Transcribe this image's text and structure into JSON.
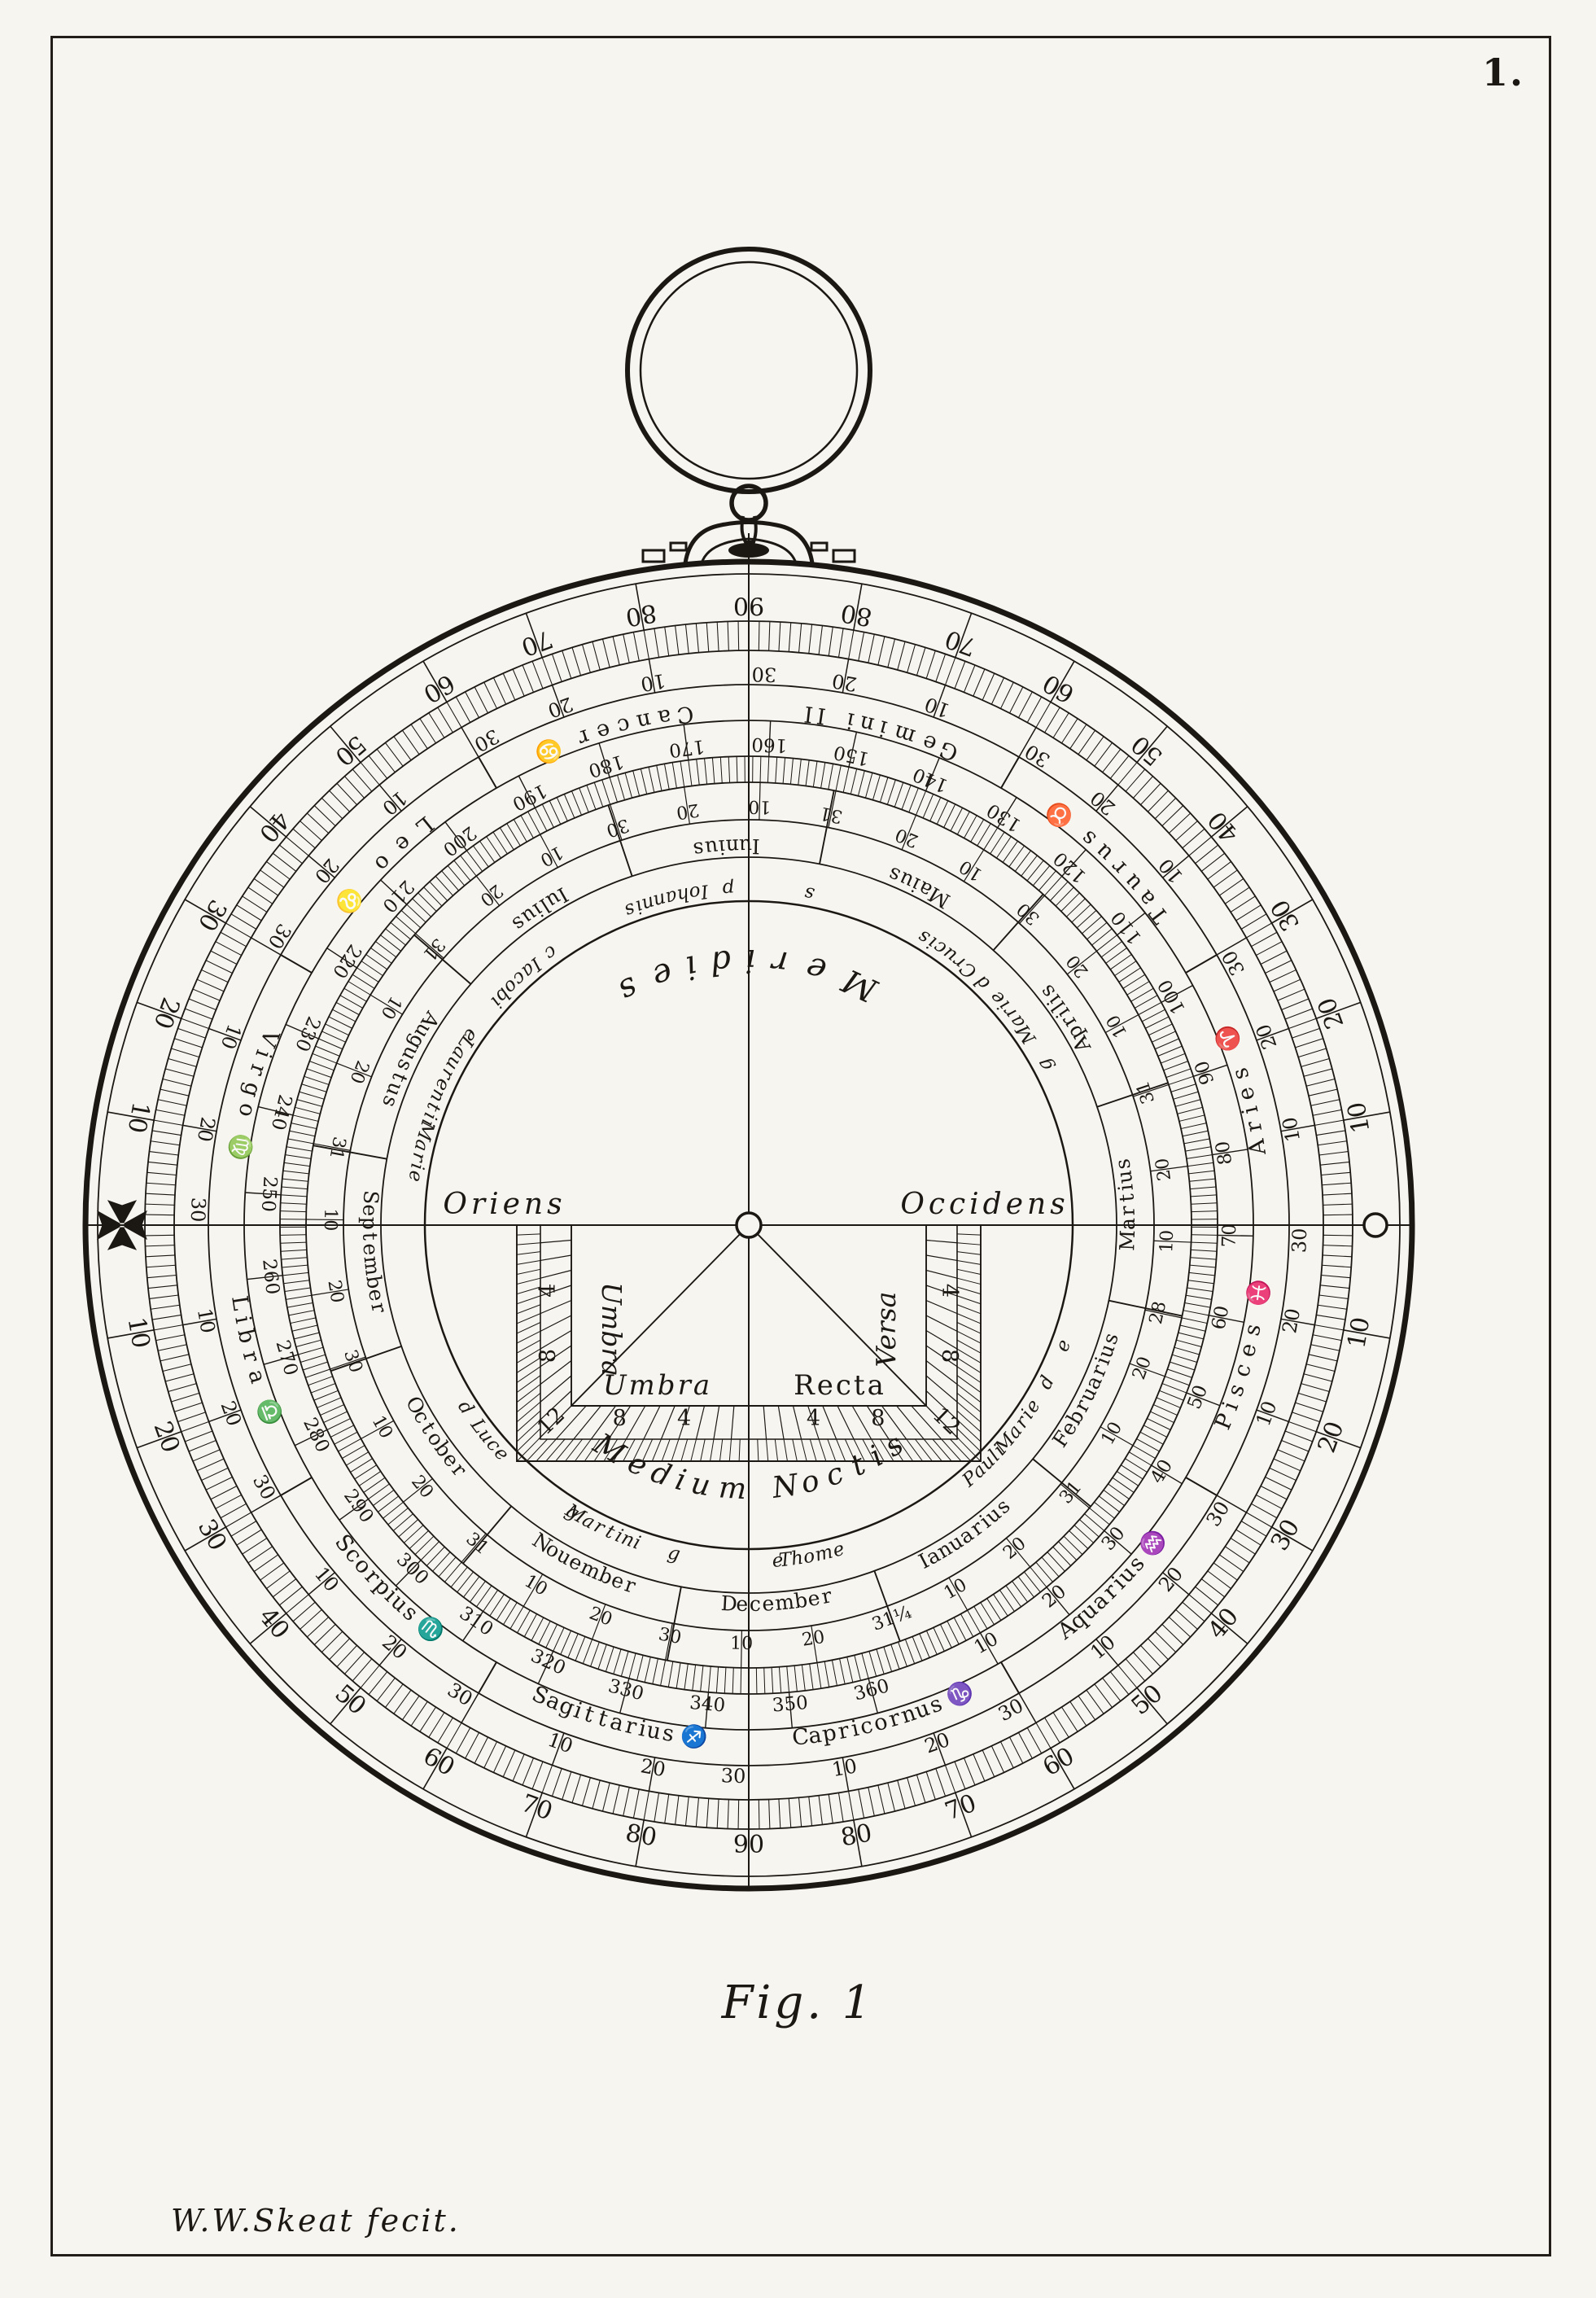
{
  "plate": {
    "number": "1.",
    "caption": "Fig. 1",
    "signature": "W.W.Skeat fecit."
  },
  "astrolabe": {
    "center_labels": {
      "top": "Meridies",
      "bottom": "Medium Noctis",
      "left": "Oriens",
      "right": "Occidens"
    },
    "shadow_square": {
      "left_label": "Umbra",
      "right_label": "Versa",
      "bottom_left_label": "Umbra",
      "bottom_right_label": "Recta",
      "scale_numbers": [
        4,
        8,
        12
      ]
    },
    "altitude_scale": {
      "step": 10,
      "max": 90
    },
    "zodiac_degree_labels": [
      10,
      20,
      30
    ],
    "zodiac": [
      {
        "name": "Capricornus",
        "symbol": "♑"
      },
      {
        "name": "Aquarius",
        "symbol": "♒"
      },
      {
        "name": "Pisces",
        "symbol": "♓"
      },
      {
        "name": "Aries",
        "symbol": "♈"
      },
      {
        "name": "Taurus",
        "symbol": "♉"
      },
      {
        "name": "Gemini",
        "symbol": "II"
      },
      {
        "name": "Cancer",
        "symbol": "♋"
      },
      {
        "name": "Leo",
        "symbol": "♌"
      },
      {
        "name": "Virgo",
        "symbol": "♍"
      },
      {
        "name": "Libra",
        "symbol": "♎"
      },
      {
        "name": "Scorpius",
        "symbol": "♏"
      },
      {
        "name": "Sagittarius",
        "symbol": "♐"
      }
    ],
    "day_scale": {
      "step": 10,
      "max": 360,
      "days_in_year": 365
    },
    "months": [
      {
        "name": "Ianuarius",
        "days": 31,
        "labels": [
          "10",
          "20",
          "31"
        ]
      },
      {
        "name": "Februarius",
        "days": 28,
        "labels": [
          "10",
          "20",
          "28"
        ]
      },
      {
        "name": "Martius",
        "days": 31,
        "labels": [
          "10",
          "20",
          "31"
        ]
      },
      {
        "name": "Aprilis",
        "days": 30,
        "labels": [
          "10",
          "20",
          "30"
        ]
      },
      {
        "name": "Maius",
        "days": 31,
        "labels": [
          "10",
          "20",
          "31"
        ]
      },
      {
        "name": "Iunius",
        "days": 30,
        "labels": [
          "10",
          "20",
          "30"
        ]
      },
      {
        "name": "Iulius",
        "days": 31,
        "labels": [
          "10",
          "20",
          "31"
        ]
      },
      {
        "name": "Augustus",
        "days": 31,
        "labels": [
          "10",
          "20",
          "31"
        ]
      },
      {
        "name": "September",
        "days": 30,
        "labels": [
          "10",
          "20",
          "30"
        ]
      },
      {
        "name": "October",
        "days": 31,
        "labels": [
          "10",
          "20",
          "31"
        ]
      },
      {
        "name": "Nouember",
        "days": 30,
        "labels": [
          "10",
          "20",
          "30"
        ]
      },
      {
        "name": "December",
        "days": 31,
        "labels": [
          "10",
          "20",
          "31¼"
        ]
      }
    ],
    "saints_ring": [
      {
        "text": "Pauli",
        "day": 25
      },
      {
        "text": "Marie",
        "day": 34
      },
      {
        "text": "d",
        "day": 43
      },
      {
        "text": "e",
        "day": 50
      },
      {
        "text": "g",
        "day": 100
      },
      {
        "text": "Marie",
        "day": 110
      },
      {
        "text": "d",
        "day": 118
      },
      {
        "text": "Crucis",
        "day": 126
      },
      {
        "text": "s",
        "day": 152
      },
      {
        "text": "p",
        "day": 166
      },
      {
        "text": "Iohannis",
        "day": 177
      },
      {
        "text": "c",
        "day": 199
      },
      {
        "text": "Iacobi",
        "day": 207
      },
      {
        "text": "e",
        "day": 219
      },
      {
        "text": "Laurentii",
        "day": 228
      },
      {
        "text": "Marie",
        "day": 241
      },
      {
        "text": "d",
        "day": 287
      },
      {
        "text": "Luce",
        "day": 294
      },
      {
        "text": "g",
        "day": 313
      },
      {
        "text": "Martini",
        "day": 319
      },
      {
        "text": "g",
        "day": 332
      },
      {
        "text": "e",
        "day": 350
      },
      {
        "text": "Thome",
        "day": 356
      }
    ]
  }
}
